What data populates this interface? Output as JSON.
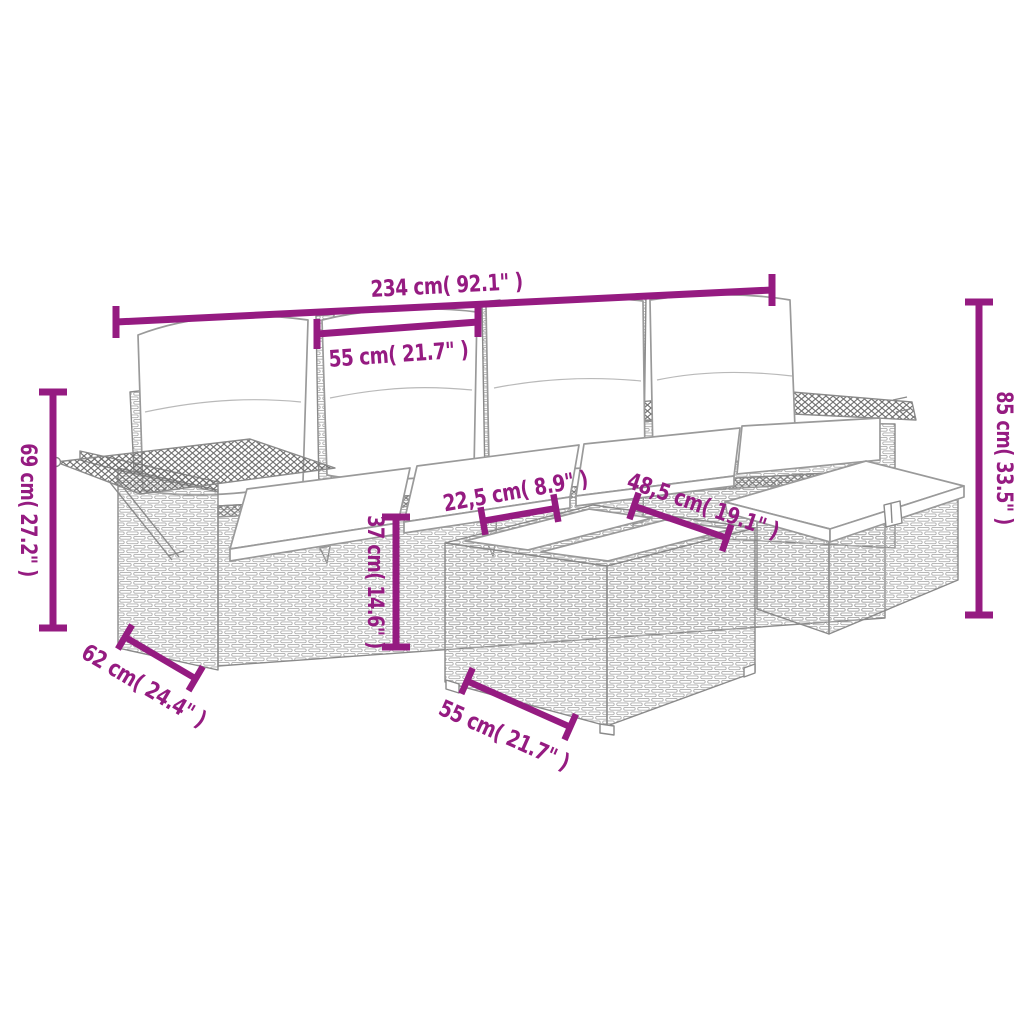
{
  "title": "Garden lounge set dimension diagram",
  "style": {
    "accent_color": "#951B81",
    "outline_color": "#8a8a8a",
    "background": "#ffffff",
    "cushion_color": "#ffffff"
  },
  "figure": {
    "type": "product-dimension-diagram",
    "subject": "poly rattan garden lounge set: 4-seat sofa with folding side shelves, storage ottoman and table with two top panels, cream cushions"
  },
  "dims": [
    {
      "id": "overall-width",
      "label": "234 cm( 92.1\" )"
    },
    {
      "id": "seat-width",
      "label": "55 cm( 21.7\" )"
    },
    {
      "id": "armrest-height",
      "label": "69 cm( 27.2\" )"
    },
    {
      "id": "total-height",
      "label": "85 cm( 33.5\" )"
    },
    {
      "id": "seat-height",
      "label": "37 cm( 14.6\" )"
    },
    {
      "id": "table-panel-width",
      "label": "22,5 cm( 8.9\" )"
    },
    {
      "id": "tabletop-width",
      "label": "48,5 cm( 19.1\" )"
    },
    {
      "id": "seat-depth",
      "label": "62 cm( 24.4\" )"
    },
    {
      "id": "table-width",
      "label": "55 cm( 21.7\" )"
    }
  ]
}
